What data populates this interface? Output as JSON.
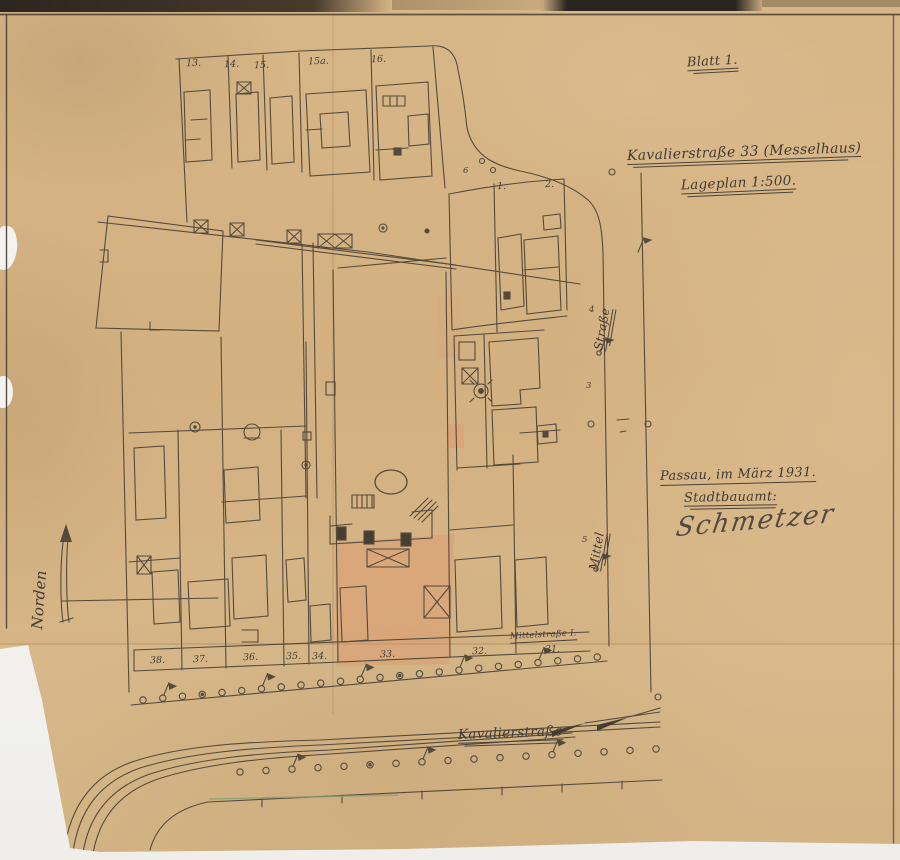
{
  "sheet": {
    "blatt": "Blatt 1.",
    "title": "Kavalierstraße 33 (Messelhaus)",
    "subtitle": "Lageplan 1:500.",
    "place_date": "Passau, im März 1931.",
    "office": "Stadtbauamt:",
    "signature": "Schmetzer",
    "north_label": "Norden"
  },
  "streets": {
    "bottom_street": "Kavalierstraße",
    "right_street_upper": "Straße",
    "right_street_lower": "Mittel",
    "corner_small_label": "Mittelstraße I."
  },
  "parcels": {
    "top_row": [
      "13.",
      "14.",
      "15.",
      "15a.",
      "16."
    ],
    "bottom_row": [
      "38.",
      "37.",
      "36.",
      "35.",
      "34.",
      "33.",
      "32.",
      "31."
    ],
    "corner_numbers": [
      "1.",
      "2."
    ],
    "house_numbers": [
      "6",
      "4",
      "3",
      "5"
    ]
  },
  "colors": {
    "paper": "#d4b384",
    "ink_lines": "#4a4237",
    "handwriting_ink": "#403a33",
    "parcel_highlight": "#e59468",
    "background_white": "#f3f2ef"
  }
}
